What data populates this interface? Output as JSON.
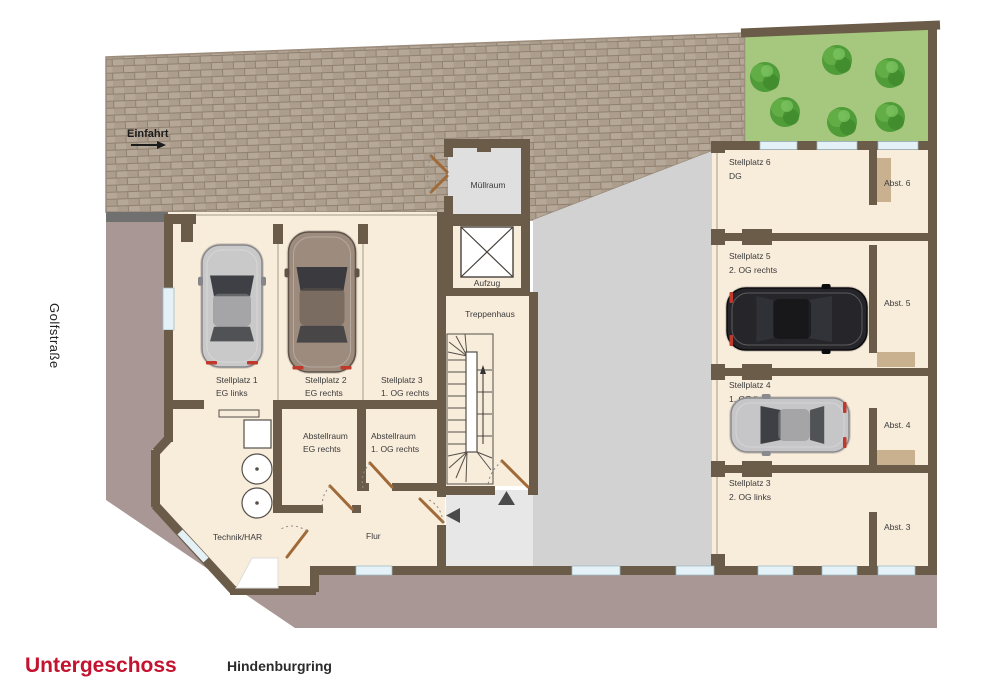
{
  "page": {
    "floor_title": "Untergeschoss",
    "street_left": "Golfstraße",
    "street_bottom": "Hindenburgring"
  },
  "driveway": {
    "label": "Einfahrt"
  },
  "plan": {
    "rooms": {
      "muellraum": "Müllraum",
      "aufzug": "Aufzug",
      "treppenhaus": "Treppenhaus",
      "technik": "Technik/HAR",
      "flur": "Flur",
      "abstellraum_eg": {
        "line1": "Abstellraum",
        "line2": "EG rechts"
      },
      "abstellraum_og": {
        "line1": "Abstellraum",
        "line2": "1. OG rechts"
      }
    },
    "parking_left": [
      {
        "line1": "Stellplatz 1",
        "line2": "EG links"
      },
      {
        "line1": "Stellplatz 2",
        "line2": "EG rechts"
      },
      {
        "line1": "Stellplatz 3",
        "line2": "1. OG rechts"
      }
    ],
    "parking_right": [
      {
        "line1": "Stellplatz 6",
        "line2": "DG",
        "abst": "Abst. 6"
      },
      {
        "line1": "Stellplatz 5",
        "line2": "2. OG rechts",
        "abst": "Abst. 5"
      },
      {
        "line1": "Stellplatz 4",
        "line2": "1. OG links",
        "abst": "Abst. 4"
      },
      {
        "line1": "Stellplatz 3",
        "line2": "2. OG links",
        "abst": "Abst. 3"
      }
    ],
    "cars": [
      {
        "name": "car-silver-stellplatz-1",
        "x": 232,
        "y": 306,
        "angle": 0,
        "length": 122,
        "width": 60,
        "color": "#c9c9c9",
        "dark": "#86868a"
      },
      {
        "name": "car-bronze-stellplatz-2",
        "x": 322,
        "y": 302,
        "angle": 0,
        "length": 140,
        "width": 67,
        "color": "#9d8b7e",
        "dark": "#5f5349"
      },
      {
        "name": "car-black-stellplatz-5",
        "x": 797,
        "y": 319,
        "angle": 90,
        "length": 140,
        "width": 62,
        "color": "#26262a",
        "dark": "#0c0c0e"
      },
      {
        "name": "car-silver-stellplatz-4",
        "x": 790,
        "y": 425,
        "angle": -90,
        "length": 118,
        "width": 54,
        "color": "#c6c6c8",
        "dark": "#8a8a8e"
      }
    ],
    "trees": [
      {
        "x": 765,
        "y": 77
      },
      {
        "x": 837,
        "y": 60
      },
      {
        "x": 890,
        "y": 73
      },
      {
        "x": 785,
        "y": 112
      },
      {
        "x": 842,
        "y": 122
      },
      {
        "x": 890,
        "y": 117
      }
    ]
  },
  "colors": {
    "accent_red": "#c4122f",
    "wall": "#6b5c49",
    "floor": "#f8ecdb",
    "gray_room": "#dfdfdf",
    "courtyard": "#d2d2d2",
    "vestibule": "#e7e7e7",
    "exterior": "#a89795",
    "brick_base": "#b6a898",
    "garden": "#a6c77e",
    "tree": "#4f9c38",
    "door": "#a06a38",
    "closet_tan": "#c9b18f",
    "window": "#e4f2f7",
    "dark_bar": "#707070",
    "label_text": "#3b3b3b"
  }
}
